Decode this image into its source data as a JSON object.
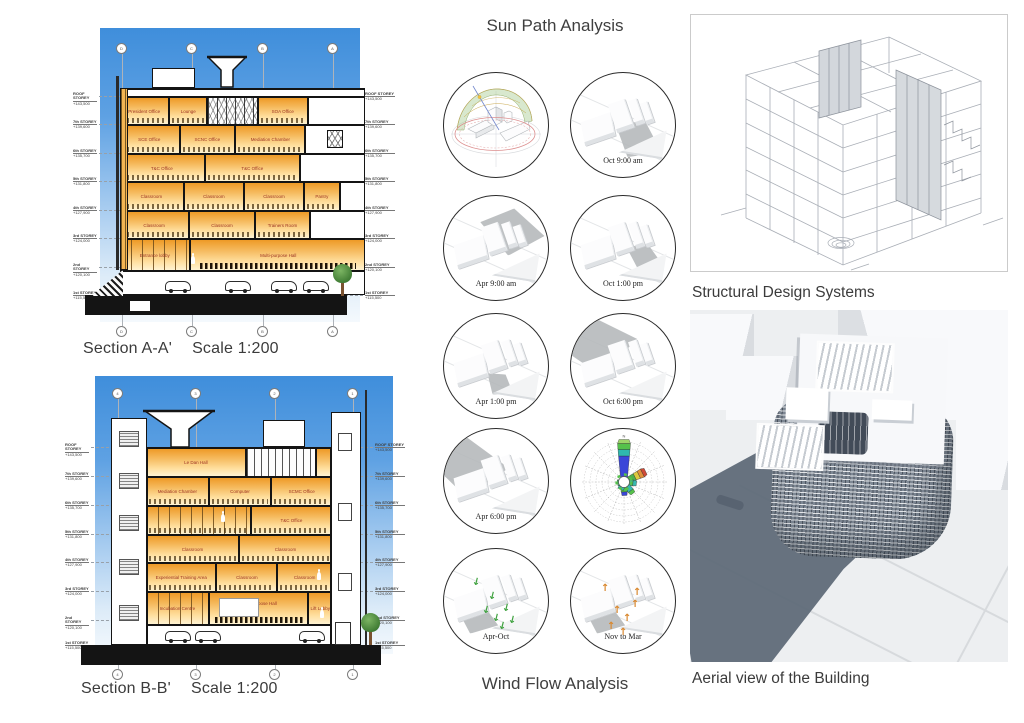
{
  "titles": {
    "sun": "Sun Path Analysis",
    "wind": "Wind Flow Analysis",
    "structural": "Structural Design Systems",
    "aerial": "Aerial view of the Building"
  },
  "sections": {
    "a": {
      "name": "Section A-A'",
      "scale": "Scale 1:200",
      "grid_top": [
        "D",
        "C",
        "B",
        "A"
      ],
      "grid_bottom": [
        "D",
        "C",
        "B",
        "A"
      ],
      "levels": [
        {
          "name": "ROOF STOREY",
          "elev": "+143,500"
        },
        {
          "name": "7th STOREY",
          "elev": "+139,600"
        },
        {
          "name": "6th STOREY",
          "elev": "+135,700"
        },
        {
          "name": "5th STOREY",
          "elev": "+131,800"
        },
        {
          "name": "4th STOREY",
          "elev": "+127,900"
        },
        {
          "name": "3rd STOREY",
          "elev": "+124,000"
        },
        {
          "name": "2nd STOREY",
          "elev": "+120,100"
        },
        {
          "name": "1st STOREY",
          "elev": "+115,500"
        }
      ],
      "rooms": {
        "f7": [
          "President Office",
          "Lounge",
          "SOA Office"
        ],
        "f6": [
          "SCE Office",
          "SCNC Office",
          "Mediation Chamber"
        ],
        "f5": [
          "T&C Office",
          "T&C Office"
        ],
        "f4": [
          "Classroom",
          "Classroom",
          "Classroom",
          "Pantry"
        ],
        "f3": [
          "Classroom",
          "Classroom",
          "Trainers Room"
        ],
        "f2": [
          "Entrance lobby",
          "Multi-purpose Hall"
        ]
      }
    },
    "b": {
      "name": "Section B-B'",
      "scale": "Scale 1:200",
      "grid_top": [
        "4",
        "3",
        "2",
        "1"
      ],
      "grid_bottom": [
        "4",
        "3",
        "2",
        "1"
      ],
      "levels": [
        {
          "name": "ROOF STOREY",
          "elev": "+143,500"
        },
        {
          "name": "7th STOREY",
          "elev": "+139,600"
        },
        {
          "name": "6th STOREY",
          "elev": "+135,700"
        },
        {
          "name": "5th STOREY",
          "elev": "+131,800"
        },
        {
          "name": "4th STOREY",
          "elev": "+127,900"
        },
        {
          "name": "3rd STOREY",
          "elev": "+124,000"
        },
        {
          "name": "2nd STOREY",
          "elev": "+120,100"
        },
        {
          "name": "1st STOREY",
          "elev": "+115,500"
        }
      ],
      "rooms": {
        "f7": [
          "Le Dan Hall"
        ],
        "f6": [
          "Mediation Chamber",
          "Computer",
          "SCMC Office"
        ],
        "f5": [
          "T&C Office"
        ],
        "f4": [
          "Classroom",
          "Classroom"
        ],
        "f3": [
          "Experiential Training Area",
          "Classroom",
          "Classroom"
        ],
        "f2": [
          "Incubation Centre",
          "Multi-purpose Hall",
          "Lift Lobby"
        ]
      }
    }
  },
  "sun_study": {
    "labels": [
      "Oct 9:00 am",
      "Apr 9:00 am",
      "Oct 1:00 pm",
      "Apr 1:00 pm",
      "Oct 6:00 pm",
      "Apr 6:00 pm"
    ]
  },
  "wind_study": {
    "labels": [
      "Apr-Oct",
      "Nov to Mar"
    ],
    "rose_north": "N"
  },
  "colors": {
    "sky_top": "#3f8edb",
    "room_orange": "#ee9a26",
    "label_red": "#9c3424",
    "shadow_slate": "#5c6876",
    "arrow_green": "#3fa23f",
    "arrow_orange": "#d9882f"
  }
}
